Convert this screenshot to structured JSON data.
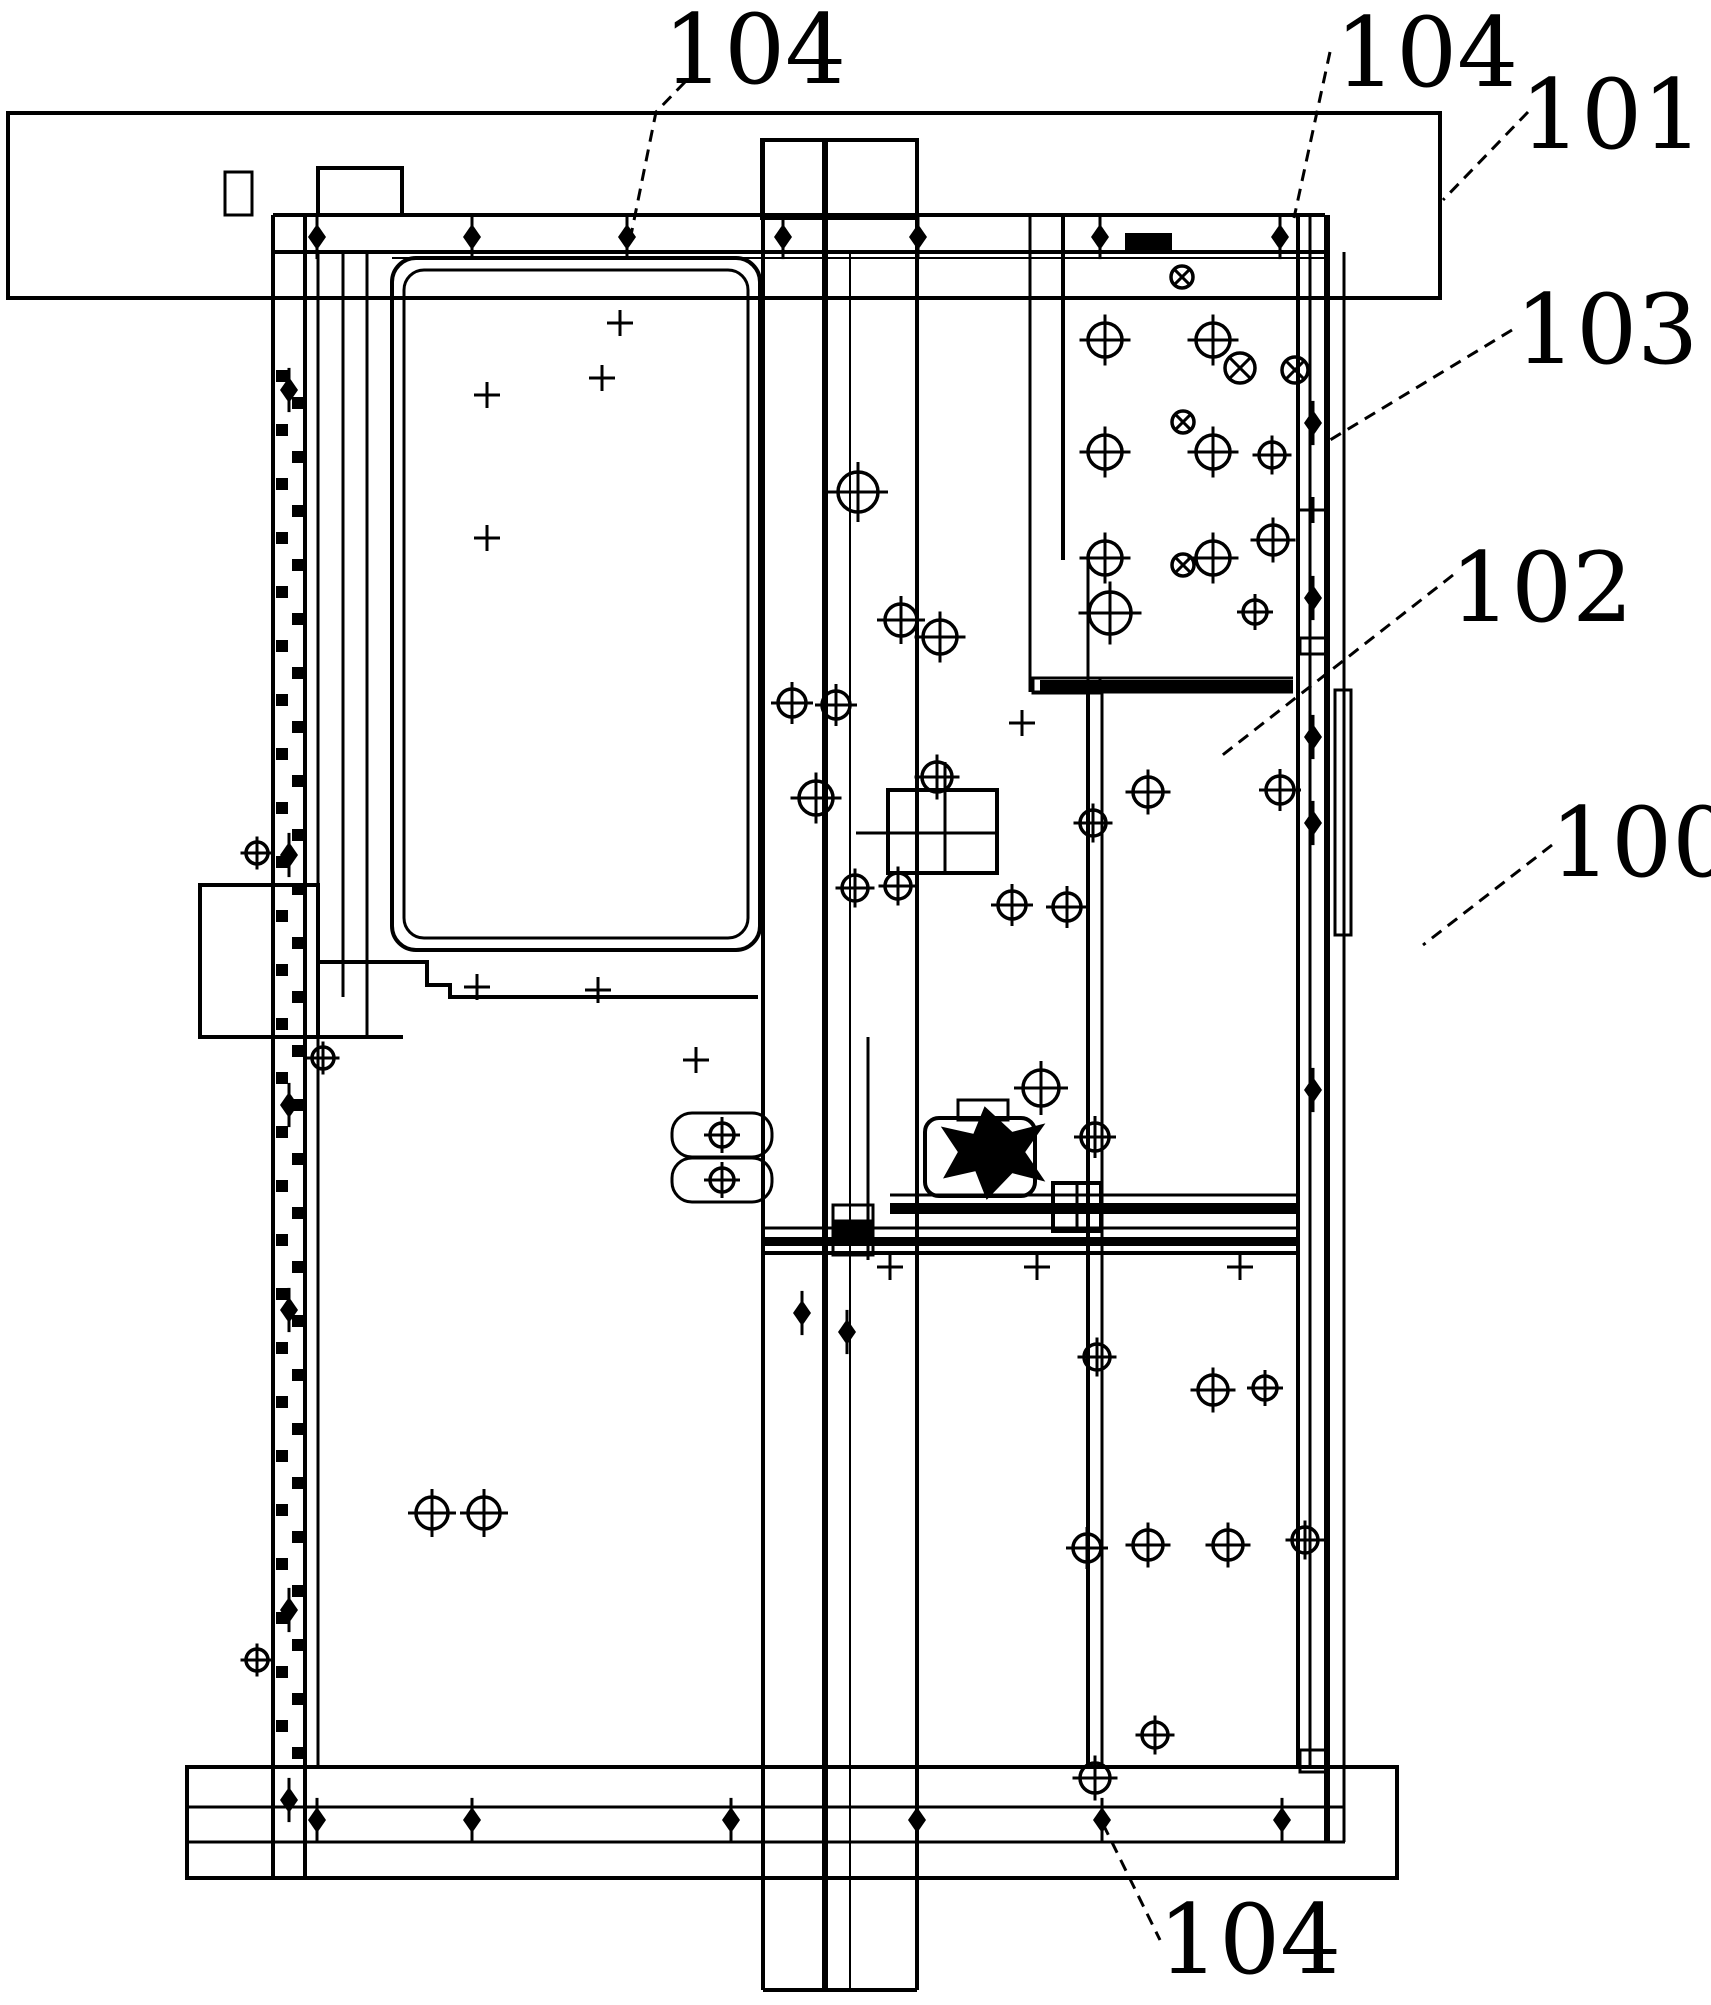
{
  "figure": {
    "kind": "patent-mechanical-drawing",
    "canvas": {
      "width": 1711,
      "height": 2005,
      "background": "#ffffff",
      "line_color": "#000000"
    },
    "labels": [
      {
        "id": "ref-104-top-left",
        "text": "104",
        "x": 663,
        "y": 5,
        "font": 96,
        "leader": [
          [
            685,
            82
          ],
          [
            656,
            112
          ],
          [
            630,
            240
          ]
        ]
      },
      {
        "id": "ref-104-top-right",
        "text": "104",
        "x": 1335,
        "y": 8,
        "font": 96,
        "leader": [
          [
            1330,
            52
          ],
          [
            1294,
            218
          ]
        ]
      },
      {
        "id": "ref-101",
        "text": "101",
        "x": 1520,
        "y": 70,
        "font": 96,
        "leader": [
          [
            1528,
            112
          ],
          [
            1443,
            200
          ]
        ]
      },
      {
        "id": "ref-103",
        "text": "103",
        "x": 1515,
        "y": 285,
        "font": 96,
        "leader": [
          [
            1512,
            330
          ],
          [
            1330,
            440
          ]
        ]
      },
      {
        "id": "ref-102",
        "text": "102",
        "x": 1450,
        "y": 543,
        "font": 96,
        "leader": [
          [
            1453,
            575
          ],
          [
            1220,
            757
          ]
        ]
      },
      {
        "id": "ref-100",
        "text": "100",
        "x": 1550,
        "y": 798,
        "font": 96,
        "leader": [
          [
            1552,
            845
          ],
          [
            1423,
            945
          ]
        ]
      },
      {
        "id": "ref-104-bottom",
        "text": "104",
        "x": 1158,
        "y": 1895,
        "font": 96,
        "leader": [
          [
            1103,
            1824
          ],
          [
            1160,
            1940
          ]
        ]
      }
    ],
    "shapes": {
      "rects": [
        {
          "name": "top-mount-bar",
          "x": 8,
          "y": 113,
          "w": 1432,
          "h": 185,
          "sw": 4
        },
        {
          "name": "bottom-mount-bar",
          "x": 187,
          "y": 1767,
          "w": 1210,
          "h": 111,
          "sw": 4
        },
        {
          "name": "left-top-tab",
          "x": 225,
          "y": 172,
          "w": 27,
          "h": 43,
          "sw": 3
        },
        {
          "name": "rail-top-tab",
          "x": 318,
          "y": 168,
          "w": 84,
          "h": 47,
          "sw": 4
        },
        {
          "name": "column-top-tab",
          "x": 762,
          "y": 140,
          "w": 155,
          "h": 78,
          "sw": 4
        },
        {
          "name": "door-panel-outer",
          "x": 392,
          "y": 258,
          "w": 368,
          "h": 692,
          "sw": 4,
          "rx": 24
        },
        {
          "name": "door-panel-inner",
          "x": 404,
          "y": 270,
          "w": 344,
          "h": 668,
          "sw": 3,
          "rx": 20
        },
        {
          "name": "window-grid",
          "x": 888,
          "y": 790,
          "w": 109,
          "h": 83,
          "sw": 4
        },
        {
          "name": "right-side-plate",
          "x": 1335,
          "y": 690,
          "w": 16,
          "h": 245,
          "sw": 3
        },
        {
          "name": "latch-ear-upper",
          "x": 672,
          "y": 1113,
          "w": 100,
          "h": 44,
          "sw": 3,
          "rx": 20
        },
        {
          "name": "latch-ear-lower",
          "x": 672,
          "y": 1158,
          "w": 100,
          "h": 44,
          "sw": 3,
          "rx": 20
        },
        {
          "name": "motor-body",
          "x": 925,
          "y": 1118,
          "w": 110,
          "h": 78,
          "sw": 4,
          "rx": 14
        },
        {
          "name": "motor-cap",
          "x": 958,
          "y": 1100,
          "w": 50,
          "h": 20,
          "sw": 3
        },
        {
          "name": "carriage-bracket",
          "x": 1053,
          "y": 1183,
          "w": 48,
          "h": 48,
          "sw": 4
        },
        {
          "name": "rail-joint-box",
          "x": 1300,
          "y": 1750,
          "w": 26,
          "h": 22,
          "sw": 3
        },
        {
          "name": "rail-joint-box-mid",
          "x": 1300,
          "y": 638,
          "w": 27,
          "h": 16,
          "sw": 3
        },
        {
          "name": "column-joint-a",
          "x": 833,
          "y": 1205,
          "w": 40,
          "h": 16,
          "sw": 3
        },
        {
          "name": "column-joint-b",
          "x": 833,
          "y": 1223,
          "w": 40,
          "h": 16,
          "sw": 3,
          "fill": true
        },
        {
          "name": "column-joint-c",
          "x": 833,
          "y": 1241,
          "w": 40,
          "h": 14,
          "sw": 3
        },
        {
          "name": "rail-block",
          "x": 1125,
          "y": 233,
          "w": 47,
          "h": 18,
          "sw": 0,
          "fill": true
        },
        {
          "name": "left-protrusion",
          "x": 200,
          "y": 885,
          "w": 118,
          "h": 152,
          "sw": 4
        },
        {
          "name": "slide-bar-notch",
          "x": 1033,
          "y": 678,
          "w": 67,
          "h": 15,
          "sw": 3
        },
        {
          "name": "slide-bar-fill",
          "x": 1040,
          "y": 680,
          "w": 253,
          "h": 12,
          "sw": 0,
          "fill": true
        },
        {
          "name": "carriage-bar-upper",
          "x": 890,
          "y": 1203,
          "w": 410,
          "h": 11,
          "sw": 0,
          "fill": true
        },
        {
          "name": "carriage-bar-lower",
          "x": 763,
          "y": 1237,
          "w": 537,
          "h": 9,
          "sw": 0,
          "fill": true
        }
      ],
      "lines": [
        {
          "name": "top-rail-top",
          "p": [
            273,
            215,
            1325,
            215
          ],
          "sw": 4
        },
        {
          "name": "top-rail-bottom",
          "p": [
            273,
            252,
            1325,
            252
          ],
          "sw": 4
        },
        {
          "name": "top-rail-inner",
          "p": [
            392,
            258,
            1325,
            258
          ],
          "sw": 2
        },
        {
          "name": "left-rail-outer",
          "p": [
            273,
            215,
            273,
            1878
          ],
          "sw": 4
        },
        {
          "name": "left-rail-inner",
          "p": [
            305,
            215,
            305,
            1878
          ],
          "sw": 4
        },
        {
          "name": "left-plate-1",
          "p": [
            318,
            252,
            318,
            1767
          ],
          "sw": 3
        },
        {
          "name": "left-plate-2",
          "p": [
            343,
            252,
            343,
            997
          ],
          "sw": 3
        },
        {
          "name": "left-plate-3",
          "p": [
            367,
            252,
            367,
            1037
          ],
          "sw": 3
        },
        {
          "name": "column-left",
          "p": [
            763,
            140,
            763,
            1990
          ],
          "sw": 4
        },
        {
          "name": "column-right",
          "p": [
            917,
            140,
            917,
            1990
          ],
          "sw": 4
        },
        {
          "name": "column-mid-thick",
          "p": [
            825,
            140,
            825,
            1990
          ],
          "sw": 6
        },
        {
          "name": "column-mid-thin",
          "p": [
            850,
            252,
            850,
            1990
          ],
          "sw": 2
        },
        {
          "name": "column-mid-short",
          "p": [
            868,
            1037,
            868,
            1260
          ],
          "sw": 3
        },
        {
          "name": "column-bottom-cap",
          "p": [
            763,
            1990,
            917,
            1990
          ],
          "sw": 4
        },
        {
          "name": "right-rail-1",
          "p": [
            1298,
            215,
            1298,
            1767
          ],
          "sw": 4
        },
        {
          "name": "right-rail-2",
          "p": [
            1310,
            215,
            1310,
            1767
          ],
          "sw": 3
        },
        {
          "name": "right-rail-thick",
          "p": [
            1327,
            215,
            1327,
            1842
          ],
          "sw": 6
        },
        {
          "name": "right-rail-3",
          "p": [
            1344,
            252,
            1344,
            1842
          ],
          "sw": 3
        },
        {
          "name": "panel103-left",
          "p": [
            1063,
            215,
            1063,
            560
          ],
          "sw": 4
        },
        {
          "name": "mid-column-left",
          "p": [
            1030,
            215,
            1030,
            692
          ],
          "sw": 3
        },
        {
          "name": "panel102-left",
          "p": [
            1088,
            560,
            1088,
            692
          ],
          "sw": 3
        },
        {
          "name": "panelBR-left",
          "p": [
            1088,
            692,
            1088,
            1767
          ],
          "sw": 4
        },
        {
          "name": "panelBR-left2",
          "p": [
            1102,
            692,
            1102,
            1767
          ],
          "sw": 3
        },
        {
          "name": "slide-bar-top",
          "p": [
            1033,
            678,
            1293,
            678
          ],
          "sw": 3
        },
        {
          "name": "slide-bar-bottom",
          "p": [
            1033,
            692,
            1293,
            692
          ],
          "sw": 3
        },
        {
          "name": "carriage-top-line",
          "p": [
            890,
            1195,
            1300,
            1195
          ],
          "sw": 3
        },
        {
          "name": "carriage-mid-line",
          "p": [
            763,
            1228,
            1300,
            1228
          ],
          "sw": 3
        },
        {
          "name": "carriage-bot-line",
          "p": [
            763,
            1253,
            1300,
            1253
          ],
          "sw": 4
        },
        {
          "name": "bottom-rail-top",
          "p": [
            187,
            1807,
            1345,
            1807
          ],
          "sw": 3
        },
        {
          "name": "bottom-rail-bot",
          "p": [
            187,
            1842,
            1345,
            1842
          ],
          "sw": 3
        },
        {
          "name": "step-base",
          "p": [
            318,
            1037,
            403,
            1037
          ],
          "sw": 4
        },
        {
          "name": "grid-mid-h",
          "p": [
            888,
            833,
            997,
            833
          ],
          "sw": 3
        },
        {
          "name": "grid-mid-v",
          "p": [
            945,
            790,
            945,
            873
          ],
          "sw": 3
        },
        {
          "name": "grid-stem",
          "p": [
            945,
            762,
            945,
            790
          ],
          "sw": 3
        },
        {
          "name": "grid-arm",
          "p": [
            856,
            833,
            888,
            833
          ],
          "sw": 3
        },
        {
          "name": "bracket-mid",
          "p": [
            1077,
            1183,
            1077,
            1231
          ],
          "sw": 3
        }
      ],
      "polylines": [
        {
          "name": "panel-step-edge",
          "pts": [
            [
              318,
              962
            ],
            [
              427,
              962
            ],
            [
              427,
              985
            ],
            [
              450,
              985
            ],
            [
              450,
              997
            ],
            [
              758,
              997
            ]
          ],
          "sw": 4
        }
      ],
      "polygons": [
        {
          "name": "motor-pinwheel",
          "pts": [
            [
              985,
              1108
            ],
            [
              1012,
              1133
            ],
            [
              1043,
              1125
            ],
            [
              1024,
              1152
            ],
            [
              1043,
              1180
            ],
            [
              1012,
              1172
            ],
            [
              987,
              1198
            ],
            [
              976,
              1170
            ],
            [
              945,
              1177
            ],
            [
              959,
              1152
            ],
            [
              943,
              1128
            ],
            [
              974,
              1135
            ]
          ]
        }
      ],
      "crosshairs_plus": [
        [
          1105,
          340,
          17
        ],
        [
          1213,
          340,
          17
        ],
        [
          1105,
          452,
          17
        ],
        [
          1213,
          452,
          17
        ],
        [
          1272,
          455,
          13
        ],
        [
          1105,
          558,
          17
        ],
        [
          1213,
          558,
          17
        ],
        [
          1273,
          540,
          15
        ],
        [
          858,
          492,
          20
        ],
        [
          901,
          620,
          16
        ],
        [
          792,
          703,
          14
        ],
        [
          836,
          705,
          14
        ],
        [
          816,
          798,
          17
        ],
        [
          855,
          888,
          13
        ],
        [
          898,
          886,
          13
        ],
        [
          940,
          637,
          17
        ],
        [
          937,
          777,
          15
        ],
        [
          1110,
          613,
          21
        ],
        [
          1255,
          612,
          12
        ],
        [
          1148,
          792,
          15
        ],
        [
          1280,
          790,
          14
        ],
        [
          1093,
          823,
          13
        ],
        [
          1012,
          905,
          14
        ],
        [
          1067,
          907,
          14
        ],
        [
          1041,
          1088,
          18
        ],
        [
          1095,
          1137,
          14
        ],
        [
          1097,
          1357,
          13
        ],
        [
          1213,
          1390,
          15
        ],
        [
          1265,
          1388,
          12
        ],
        [
          1087,
          1548,
          14
        ],
        [
          1148,
          1545,
          15
        ],
        [
          1228,
          1545,
          15
        ],
        [
          1305,
          1540,
          13
        ],
        [
          1155,
          1735,
          13
        ],
        [
          1095,
          1778,
          15
        ],
        [
          432,
          1513,
          16
        ],
        [
          484,
          1513,
          16
        ],
        [
          722,
          1135,
          12
        ],
        [
          722,
          1180,
          12
        ],
        [
          323,
          1058,
          11
        ],
        [
          257,
          853,
          11
        ],
        [
          257,
          1660,
          11
        ]
      ],
      "crosshairs_x": [
        [
          1182,
          277,
          11
        ],
        [
          1183,
          422,
          11
        ],
        [
          1183,
          565,
          11
        ],
        [
          1240,
          368,
          15
        ],
        [
          1295,
          370,
          13
        ]
      ],
      "diamonds": [
        [
          317,
          237
        ],
        [
          472,
          237
        ],
        [
          627,
          237
        ],
        [
          783,
          237
        ],
        [
          918,
          237
        ],
        [
          1100,
          237
        ],
        [
          1280,
          237
        ],
        [
          317,
          1820
        ],
        [
          472,
          1820
        ],
        [
          731,
          1820
        ],
        [
          917,
          1820
        ],
        [
          1102,
          1820
        ],
        [
          1282,
          1820
        ],
        [
          1313,
          423
        ],
        [
          1313,
          598
        ],
        [
          1313,
          737
        ],
        [
          1313,
          823
        ],
        [
          1313,
          1090
        ],
        [
          289,
          390
        ],
        [
          289,
          855
        ],
        [
          289,
          1105
        ],
        [
          289,
          1310
        ],
        [
          289,
          1610
        ],
        [
          289,
          1800
        ],
        [
          802,
          1313
        ],
        [
          847,
          1332
        ]
      ],
      "ticks": [
        [
          620,
          323
        ],
        [
          487,
          395
        ],
        [
          487,
          538
        ],
        [
          602,
          378
        ],
        [
          477,
          987
        ],
        [
          598,
          990
        ],
        [
          890,
          1267
        ],
        [
          1037,
          1267
        ],
        [
          1240,
          1267
        ],
        [
          1313,
          510
        ],
        [
          1022,
          723
        ],
        [
          696,
          1060
        ]
      ],
      "hatch": {
        "name": "left-rail-hatch",
        "x1": 276,
        "x2": 292,
        "y0": 370,
        "y1": 1740,
        "step": 54,
        "offset": 27,
        "size": 12
      }
    }
  }
}
